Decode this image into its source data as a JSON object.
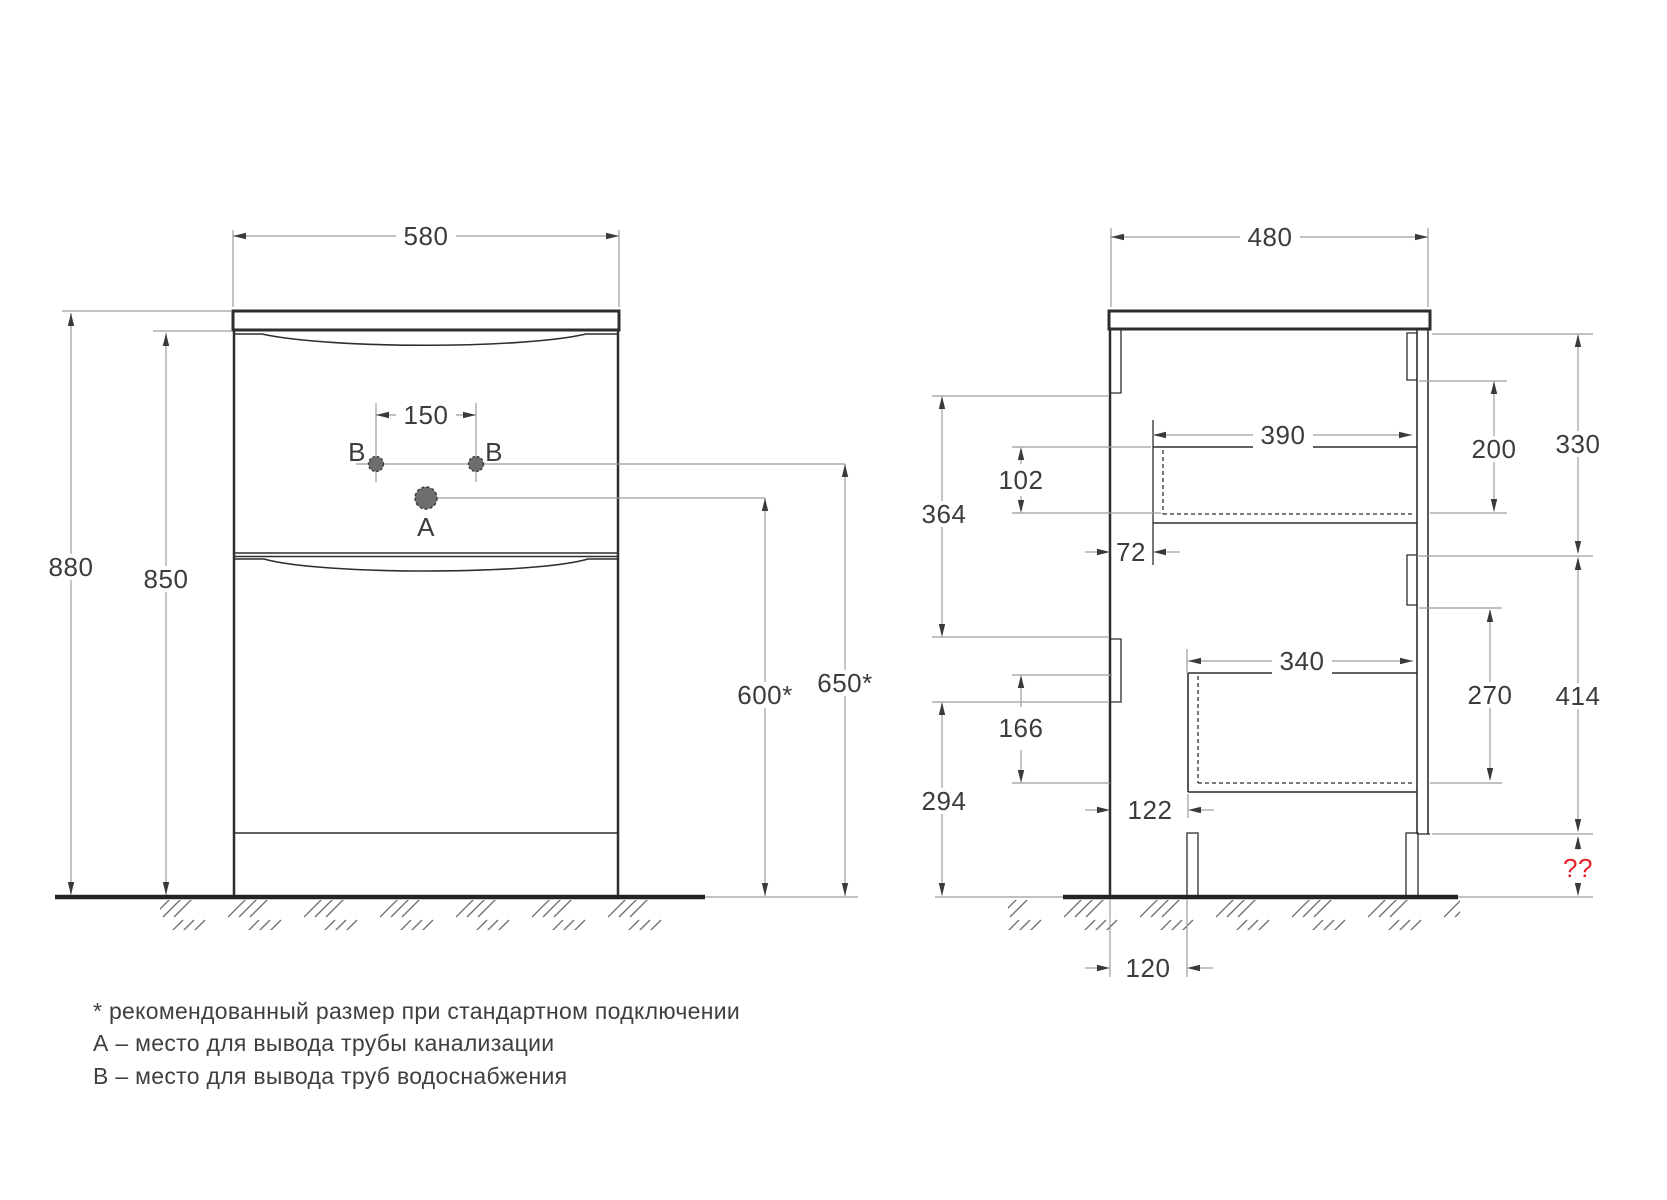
{
  "front_view": {
    "width": "580",
    "height_total": "880",
    "height_body": "850",
    "holes_spacing": "150",
    "drain_height": "600*",
    "water_height": "650*",
    "label_a": "А",
    "label_b": "В"
  },
  "side_view": {
    "depth": "480",
    "top_drawer_depth": "390",
    "top_drawer_back_height": "200",
    "top_section_height": "330",
    "top_drawer_inner_height": "102",
    "wall_to_top_drawer": "364",
    "top_drawer_front_offset": "72",
    "bottom_drawer_depth": "340",
    "bottom_drawer_back_height": "270",
    "bottom_section_height": "414",
    "bottom_drawer_inner_height": "166",
    "wall_to_bottom_drawer": "294",
    "bottom_drawer_front_offset": "122",
    "leg_inset": "120",
    "unknown_height": "??"
  },
  "notes": [
    "* рекомендованный размер при стандартном подключении",
    "А – место для вывода трубы канализации",
    "В – место для вывода труб водоснабжения"
  ],
  "colors": {
    "object_line": "#2e2e2e",
    "dim_line": "#9c9c9c",
    "dim_text": "#3c3c3c",
    "accent_red": "#e8212b",
    "marker_fill": "#6d6d6d"
  }
}
